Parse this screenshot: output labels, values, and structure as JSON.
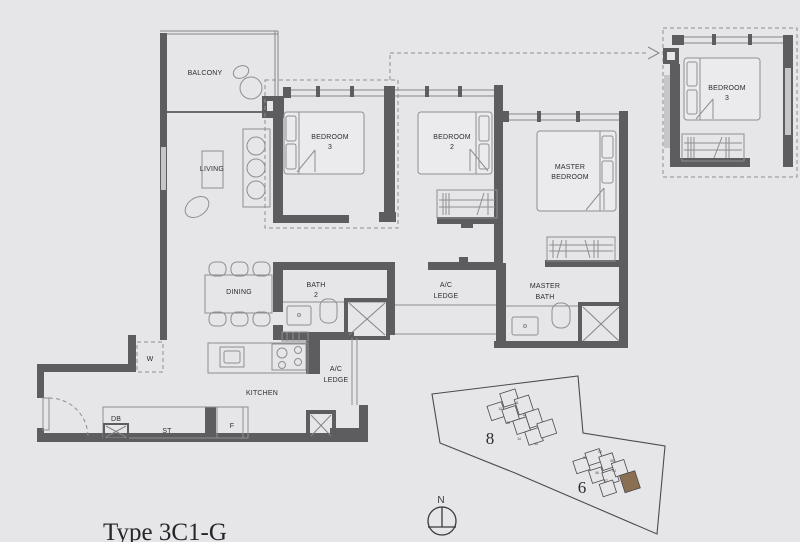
{
  "title": "Type 3C1-G",
  "labels": {
    "balcony": "BALCONY",
    "living": "LIVING",
    "bedroom3": [
      "BEDROOM",
      "3"
    ],
    "bedroom2": [
      "BEDROOM",
      "2"
    ],
    "master_bedroom": [
      "MASTER",
      "BEDROOM"
    ],
    "dining": "DINING",
    "bath2": [
      "BATH",
      "2"
    ],
    "ac_ledge": [
      "A/C",
      "LEDGE"
    ],
    "master_bath": [
      "MASTER",
      "BATH"
    ],
    "kitchen": "KITCHEN",
    "washer": "W",
    "db": "DB",
    "store": "ST",
    "fridge": "F",
    "inset_bedroom3": [
      "BEDROOM",
      "3"
    ]
  },
  "site_plan": {
    "block_8": "8",
    "block_6": "6",
    "block_8_units": [
      "10",
      "11",
      "12",
      "13",
      "14",
      "15"
    ],
    "block_6_units": [
      "01",
      "02",
      "05",
      "04",
      "06",
      "07"
    ],
    "highlight_color": "#8a6f52"
  },
  "compass": {
    "north": "N"
  },
  "colors": {
    "background": "#e6e6e8",
    "wall": "#5d5d5f",
    "text": "#2d2d30"
  }
}
